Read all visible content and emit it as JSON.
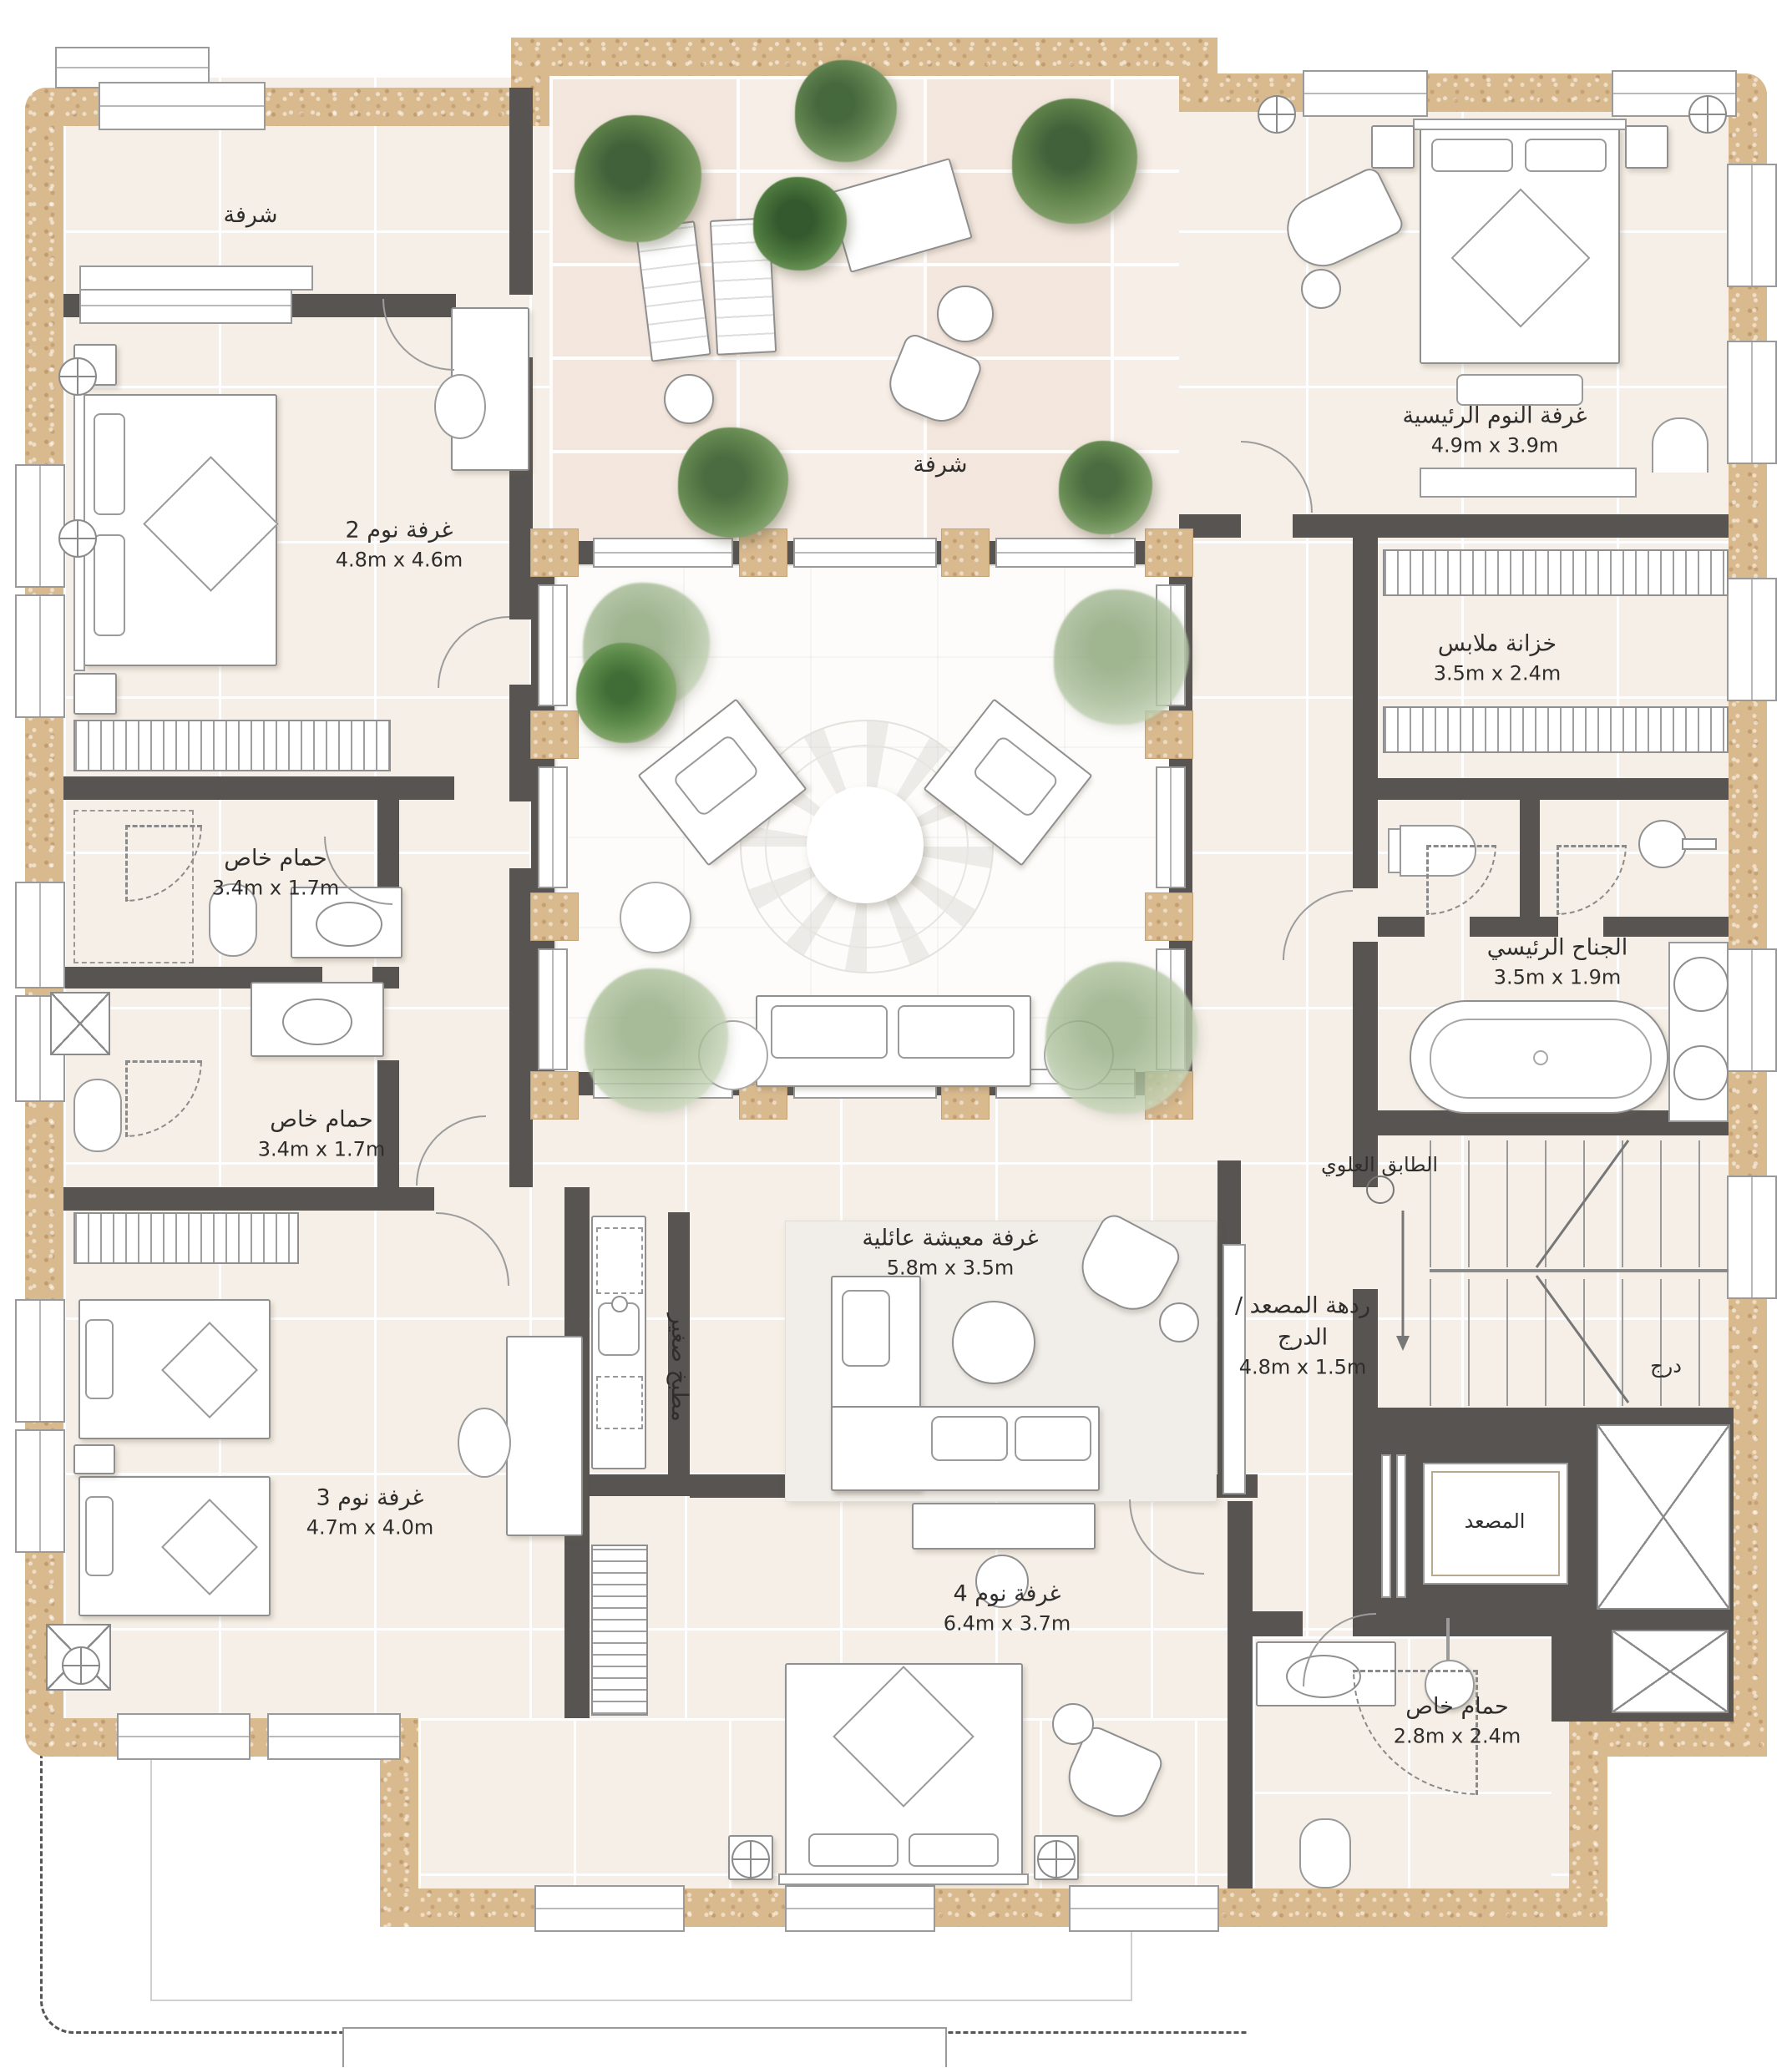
{
  "plan_title": "floor-plan-upper-level",
  "colors": {
    "stone_wall": "#d9b98e",
    "dark_wall": "#575452",
    "floor_cream": "#f5efe7",
    "courtyard_white": "#fdfcfa",
    "plant_green": "#6d9157",
    "text": "#2f2e2c"
  },
  "rooms": {
    "balcony": {
      "name": "شرفة"
    },
    "terrace": {
      "name": "شرفة"
    },
    "bedroom2": {
      "name": "غرفة نوم 2",
      "dims": "4.8m x 4.6m"
    },
    "master_bedroom": {
      "name": "غرفة النوم الرئيسية",
      "dims": "4.9m x 3.9m"
    },
    "closet": {
      "name": "خزانة ملابس",
      "dims": "3.5m x 2.4m"
    },
    "master_suite": {
      "name": "الجناح الرئيسي",
      "dims": "3.5m x 1.9m"
    },
    "bath1": {
      "name": "حمام خاص",
      "dims": "3.4m x 1.7m"
    },
    "bath2": {
      "name": "حمام خاص",
      "dims": "3.4m x 1.7m"
    },
    "family_living": {
      "name": "غرفة معيشة عائلية",
      "dims": "5.8m x 3.5m"
    },
    "kitchenette": {
      "name": "مطبخ صغير"
    },
    "lobby": {
      "name": "ردهة المصعد / الدرج",
      "dims": "4.8m x 1.5m"
    },
    "floor_tag": {
      "name": "الطابق العلوي"
    },
    "bedroom3": {
      "name": "غرفة نوم 3",
      "dims": "4.7m x 4.0m"
    },
    "bedroom4": {
      "name": "غرفة نوم 4",
      "dims": "6.4m x 3.7m"
    },
    "bath3": {
      "name": "حمام خاص",
      "dims": "2.8m x 2.4m"
    },
    "elevator": {
      "name": "المصعد"
    },
    "stairs": {
      "name": "درج"
    }
  }
}
